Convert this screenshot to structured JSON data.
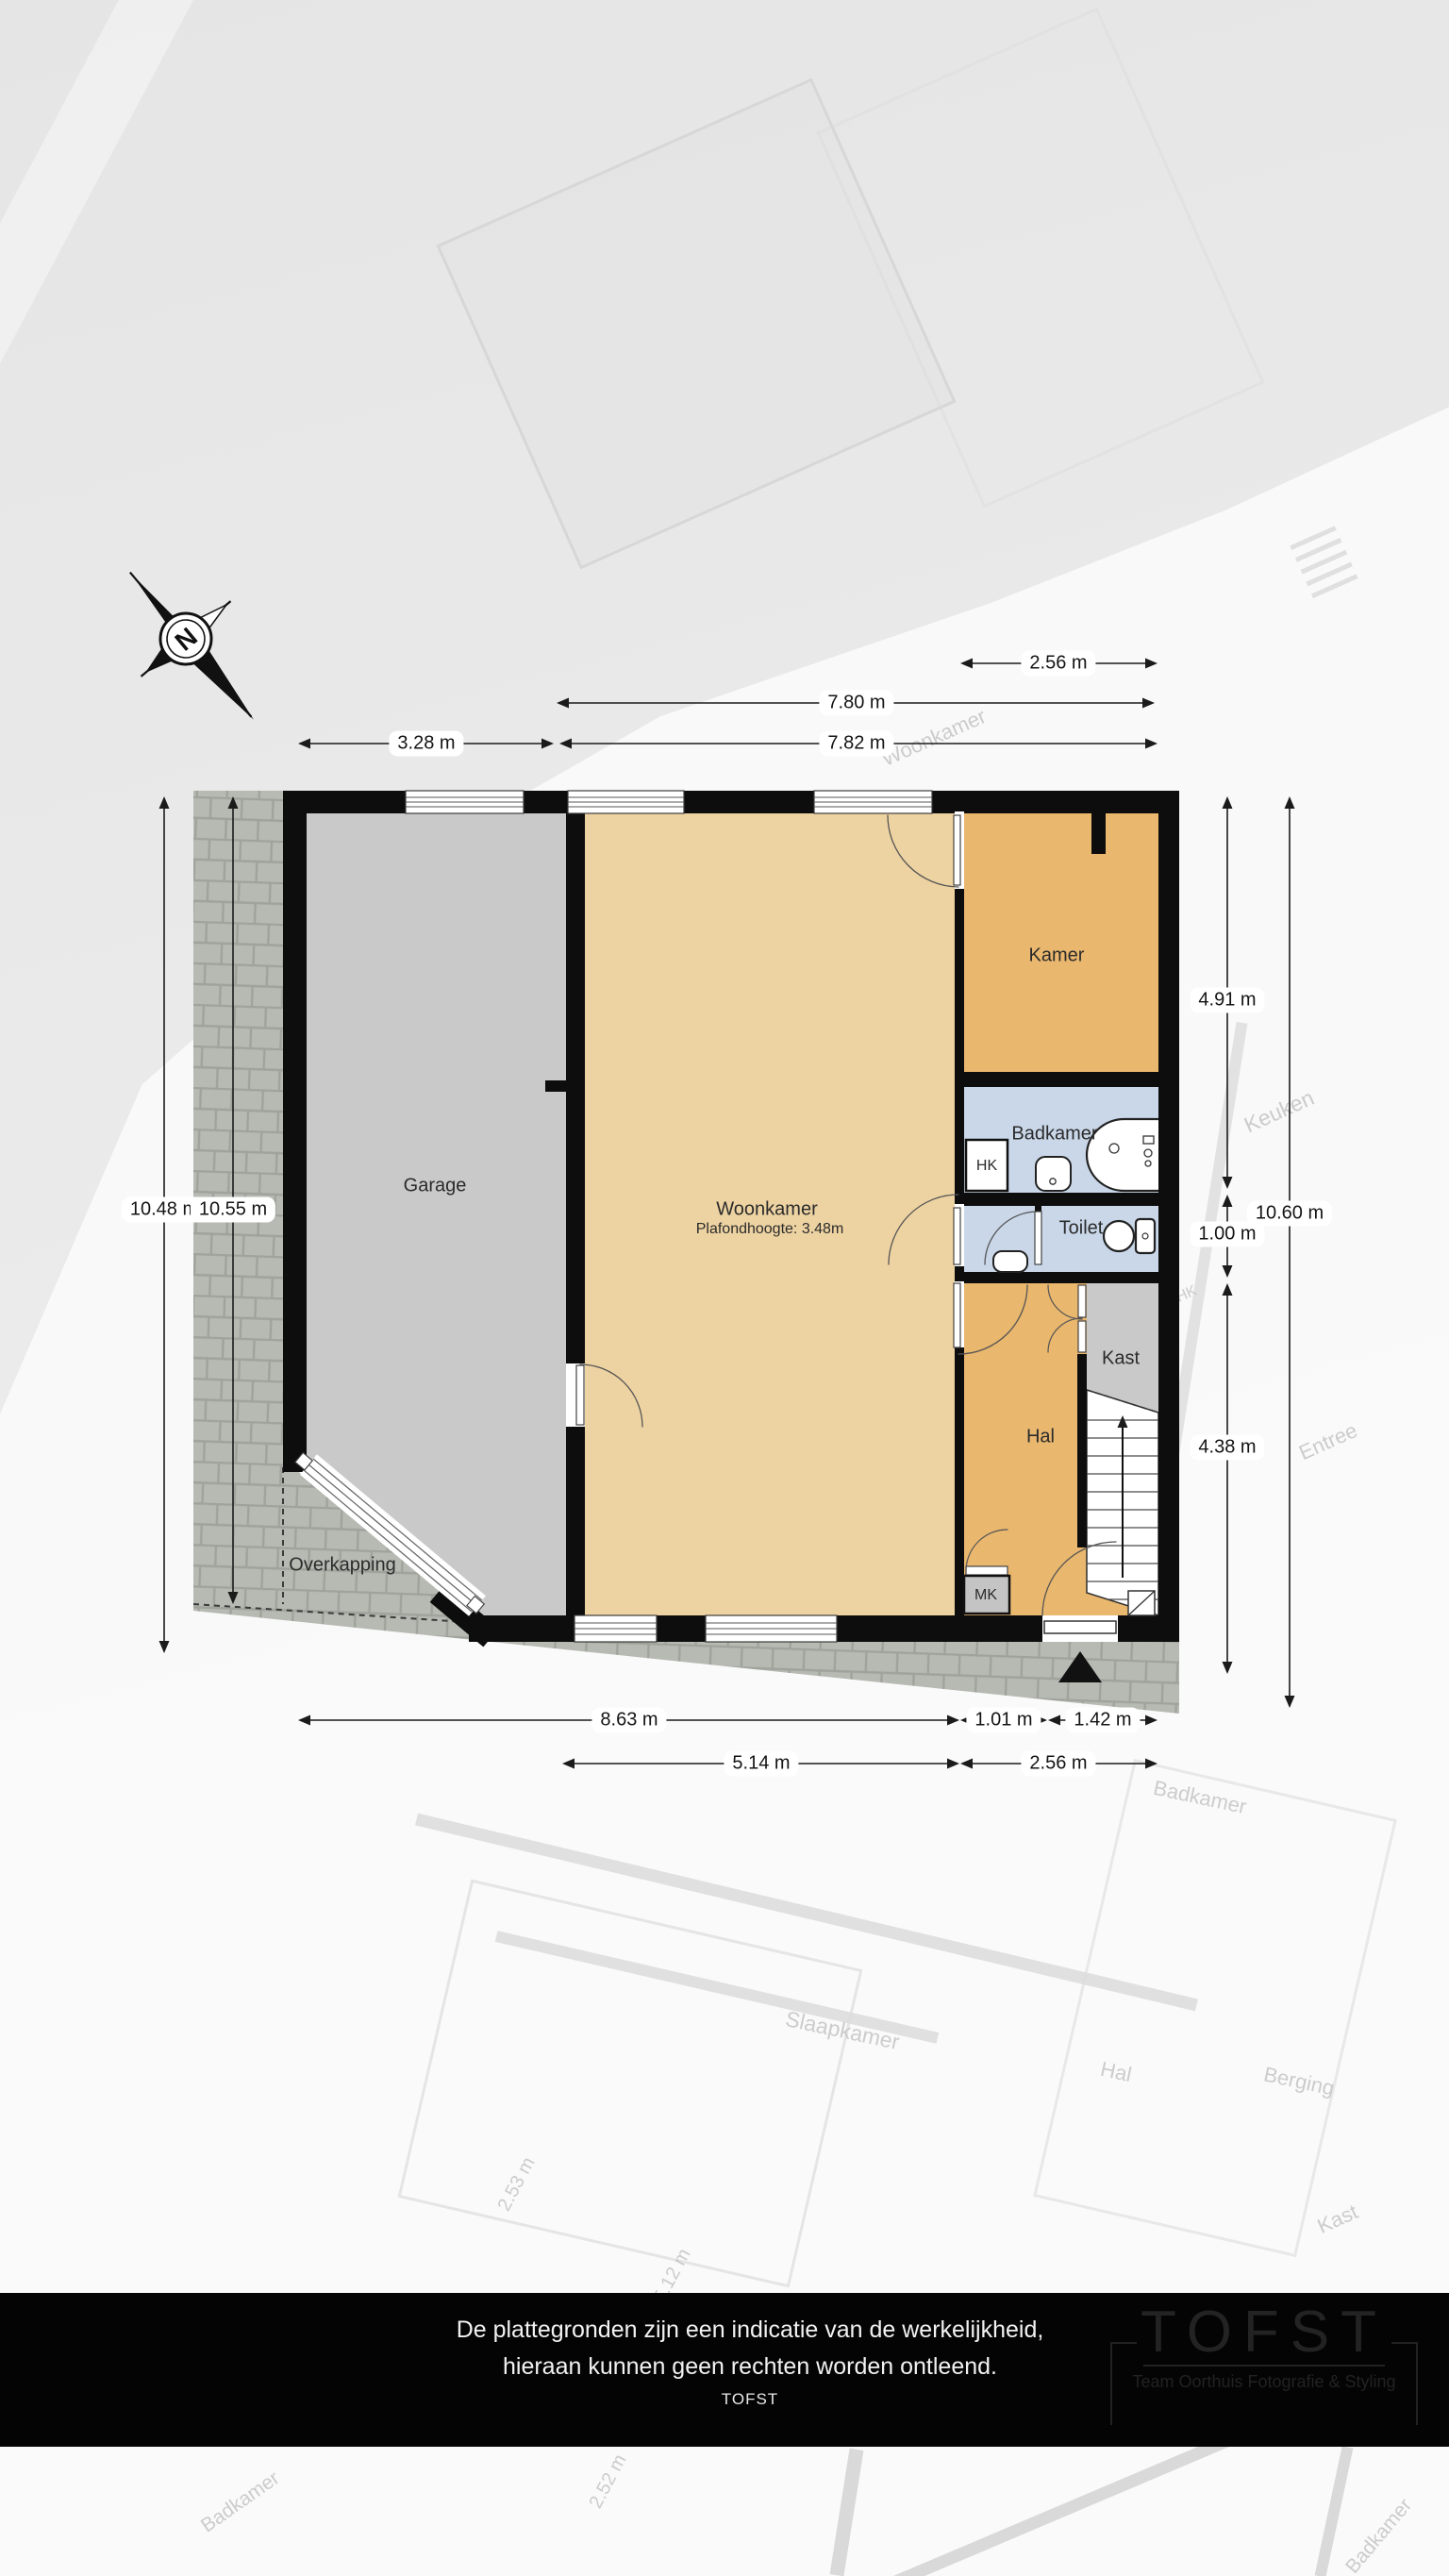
{
  "compass": {
    "letter": "N"
  },
  "rooms": {
    "garage": {
      "label": "Garage"
    },
    "woonkamer": {
      "label": "Woonkamer",
      "ceiling": "Plafondhoogte: 3.48m"
    },
    "kamer": {
      "label": "Kamer"
    },
    "badkamer": {
      "label": "Badkamer"
    },
    "hk": {
      "label": "HK"
    },
    "toilet": {
      "label": "Toilet"
    },
    "kast": {
      "label": "Kast"
    },
    "hal": {
      "label": "Hal"
    },
    "mk": {
      "label": "MK"
    },
    "overkapping": {
      "label": "Overkapping"
    }
  },
  "dimensions": {
    "top": [
      {
        "label": "2.56 m"
      },
      {
        "label": "7.80 m"
      },
      {
        "label": "3.28 m"
      },
      {
        "label": "7.82 m"
      }
    ],
    "left": [
      {
        "label": "10.48 m"
      },
      {
        "label": "10.55 m"
      }
    ],
    "right": [
      {
        "label": "4.91 m"
      },
      {
        "label": "1.00 m"
      },
      {
        "label": "10.60 m"
      },
      {
        "label": "4.38 m"
      }
    ],
    "bottom": [
      {
        "label": "8.63 m"
      },
      {
        "label": "1.01 m"
      },
      {
        "label": "1.42 m"
      },
      {
        "label": "5.14 m"
      },
      {
        "label": "2.56 m"
      }
    ]
  },
  "watermarks": [
    {
      "text": "Woonkamer"
    },
    {
      "text": "Keuken"
    },
    {
      "text": "HK"
    },
    {
      "text": "Entree"
    },
    {
      "text": "Badkamer"
    },
    {
      "text": "Slaapkamer"
    },
    {
      "text": "Hal"
    },
    {
      "text": "Berging"
    },
    {
      "text": "Kast"
    },
    {
      "text": "2.53 m"
    },
    {
      "text": "5.12 m"
    },
    {
      "text": "2.52 m"
    },
    {
      "text": "Badkamer"
    },
    {
      "text": "Badkamer"
    }
  ],
  "footer": {
    "line1": "De plattegronden zijn een indicatie van de werkelijkheid,",
    "line2": "hieraan kunnen geen rechten worden ontleend.",
    "line3": "TOFST",
    "logo_title": "TOFST",
    "logo_subtitle": "Team Oorthuis Fotografie & Styling"
  },
  "colors": {
    "wall": "#0d0d0d",
    "garage_fill": "#c9c9c9",
    "living_fill": "#eed3a2",
    "room_fill": "#e9b76e",
    "bath_fill": "#c9d7e9",
    "paving_fill": "#b7bab3",
    "footer_bar": "#040404"
  }
}
